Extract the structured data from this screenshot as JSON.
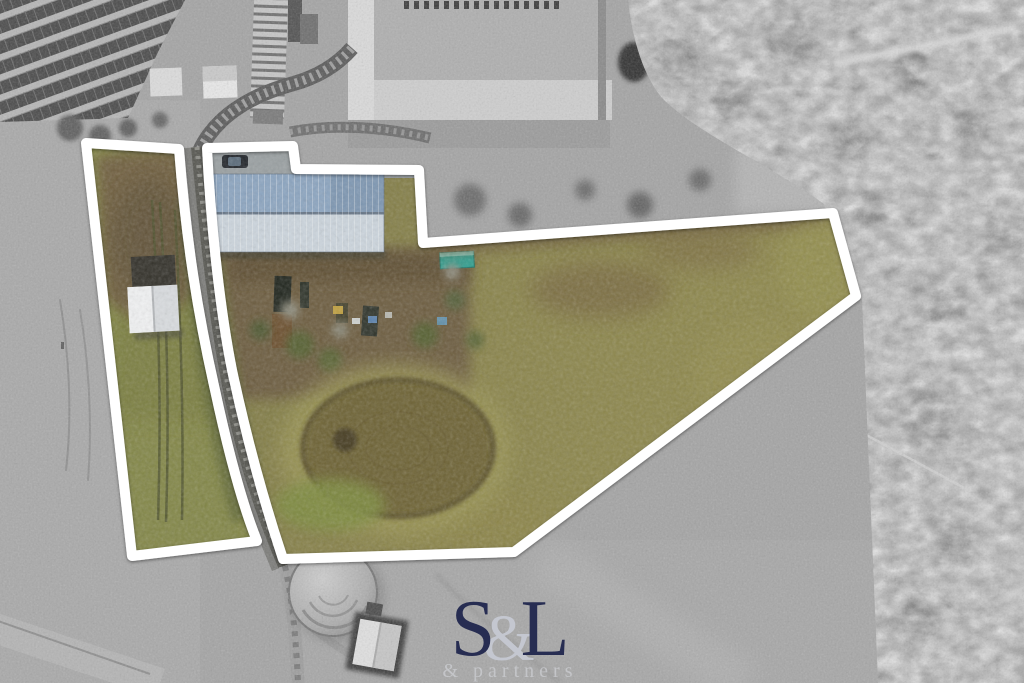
{
  "logo": {
    "letter_s": "S",
    "ampersand": "&",
    "letter_l": "L",
    "subtitle": "& partners",
    "color_letters": "#272d52",
    "color_ampersand": "#c4c7d0",
    "color_subtitle": "#dadce2"
  },
  "overlay": {
    "boundary_color": "#ffffff"
  },
  "photo_palette": {
    "background_gray": "#a2a2a2",
    "grass_olive": "#837e48",
    "dirt_brown": "#6d5d40",
    "roof_blue_top": "#8ca5c0",
    "roof_blue_bottom": "#ccd5dd",
    "container_teal": "#2f9f90",
    "pond_bed": "#6e6336"
  }
}
